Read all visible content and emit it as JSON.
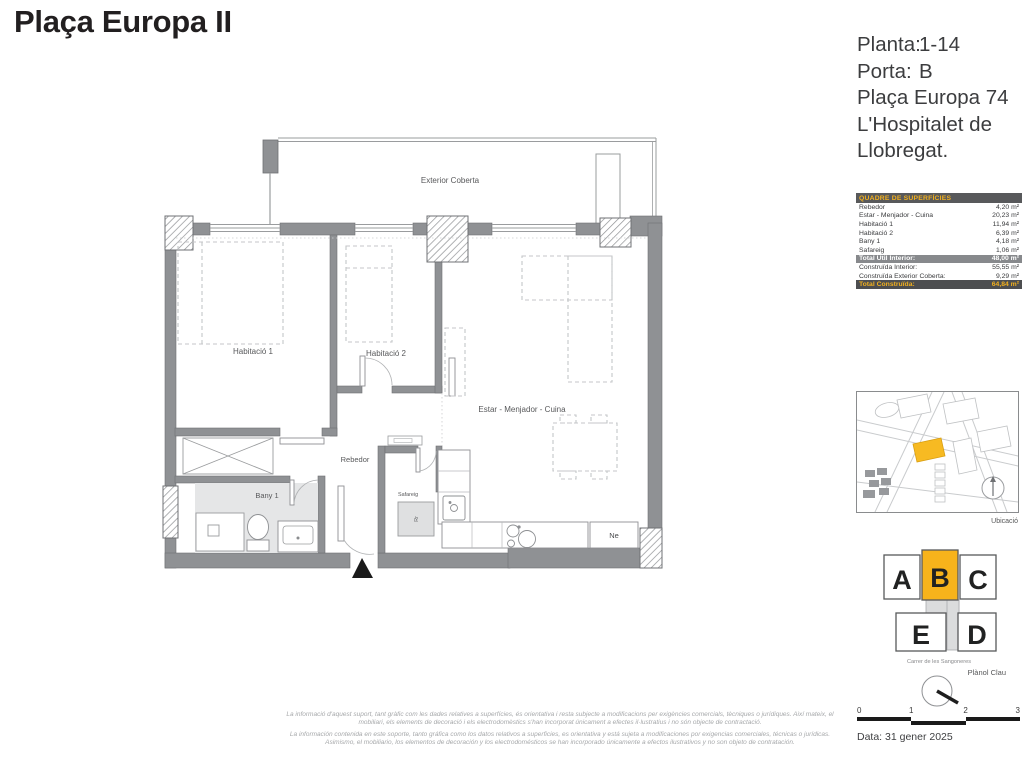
{
  "header": {
    "title": "Plaça Europa II"
  },
  "unit_info": {
    "rows": [
      {
        "label": "Planta:",
        "value": "1-14"
      },
      {
        "label": "Porta:",
        "value": "B"
      }
    ],
    "address": [
      "Plaça Europa 74",
      "L'Hospitalet de",
      "Llobregat."
    ]
  },
  "areas_table": {
    "title": "QUADRE DE SUPERFÍCIES",
    "rows": [
      {
        "label": "Rebedor",
        "value": "4,20 m²"
      },
      {
        "label": "Estar - Menjador - Cuina",
        "value": "20,23 m²"
      },
      {
        "label": "Habitació 1",
        "value": "11,94 m²"
      },
      {
        "label": "Habitació 2",
        "value": "6,39 m²"
      },
      {
        "label": "Bany 1",
        "value": "4,18 m²"
      },
      {
        "label": "Safareig",
        "value": "1,06 m²"
      }
    ],
    "totals": [
      {
        "label": "Total Útil Interior:",
        "value": "48,00 m²"
      },
      {
        "label": "Construïda Interior:",
        "value": "55,55 m²"
      },
      {
        "label": "Construïda Exterior Coberta:",
        "value": "9,29 m²"
      },
      {
        "label": "Total Construïda:",
        "value": "64,84 m²"
      }
    ]
  },
  "plan": {
    "labels": {
      "exterior": "Exterior Coberta",
      "hab1": "Habitació 1",
      "hab2": "Habitació 2",
      "estar": "Estar - Menjador - Cuina",
      "rebedor": "Rebedor",
      "bany": "Bany 1",
      "safareig": "Safareig",
      "ne": "Ne",
      "rr": "Rr"
    }
  },
  "location": {
    "caption": "Ubicació"
  },
  "keyplan": {
    "letters": [
      "A",
      "B",
      "C",
      "E",
      "D"
    ],
    "highlight": "B",
    "street": "Carrer de les Sangoneres",
    "caption": "Plànol Clau"
  },
  "scalebar": {
    "ticks": [
      "0",
      "1",
      "2",
      "3"
    ]
  },
  "footer": {
    "date": "Data: 31 gener 2025",
    "disclaimer_ca": "La informació d'aquest suport, tant gràfic com les dades relatives a superfícies, és orientativa i resta subjecte a modificacions per exigències comercials, tècniques o jurídiques. Així mateix, el mobiliari, els elements de decoració i els electrodomèstics s'han incorporat únicament a efectes il·lustratius i no són objecte de contractació.",
    "disclaimer_es": "La información contenida en este soporte, tanto gráfica como los datos relativos a superficies, es orientativa y está sujeta a modificaciones por exigencias comerciales, técnicas o jurídicas. Asimismo, el mobiliario, los elementos de decoración y los electrodomésticos se han incorporado únicamente a efectos ilustrativos y no son objeto de contratación."
  },
  "colors": {
    "accent_yellow": "#f7b31b",
    "wall_gray": "#8f9194",
    "table_header_bg": "#58595b",
    "table_total_mid_bg": "#87898c",
    "table_total_dark_bg": "#4d4e50"
  }
}
